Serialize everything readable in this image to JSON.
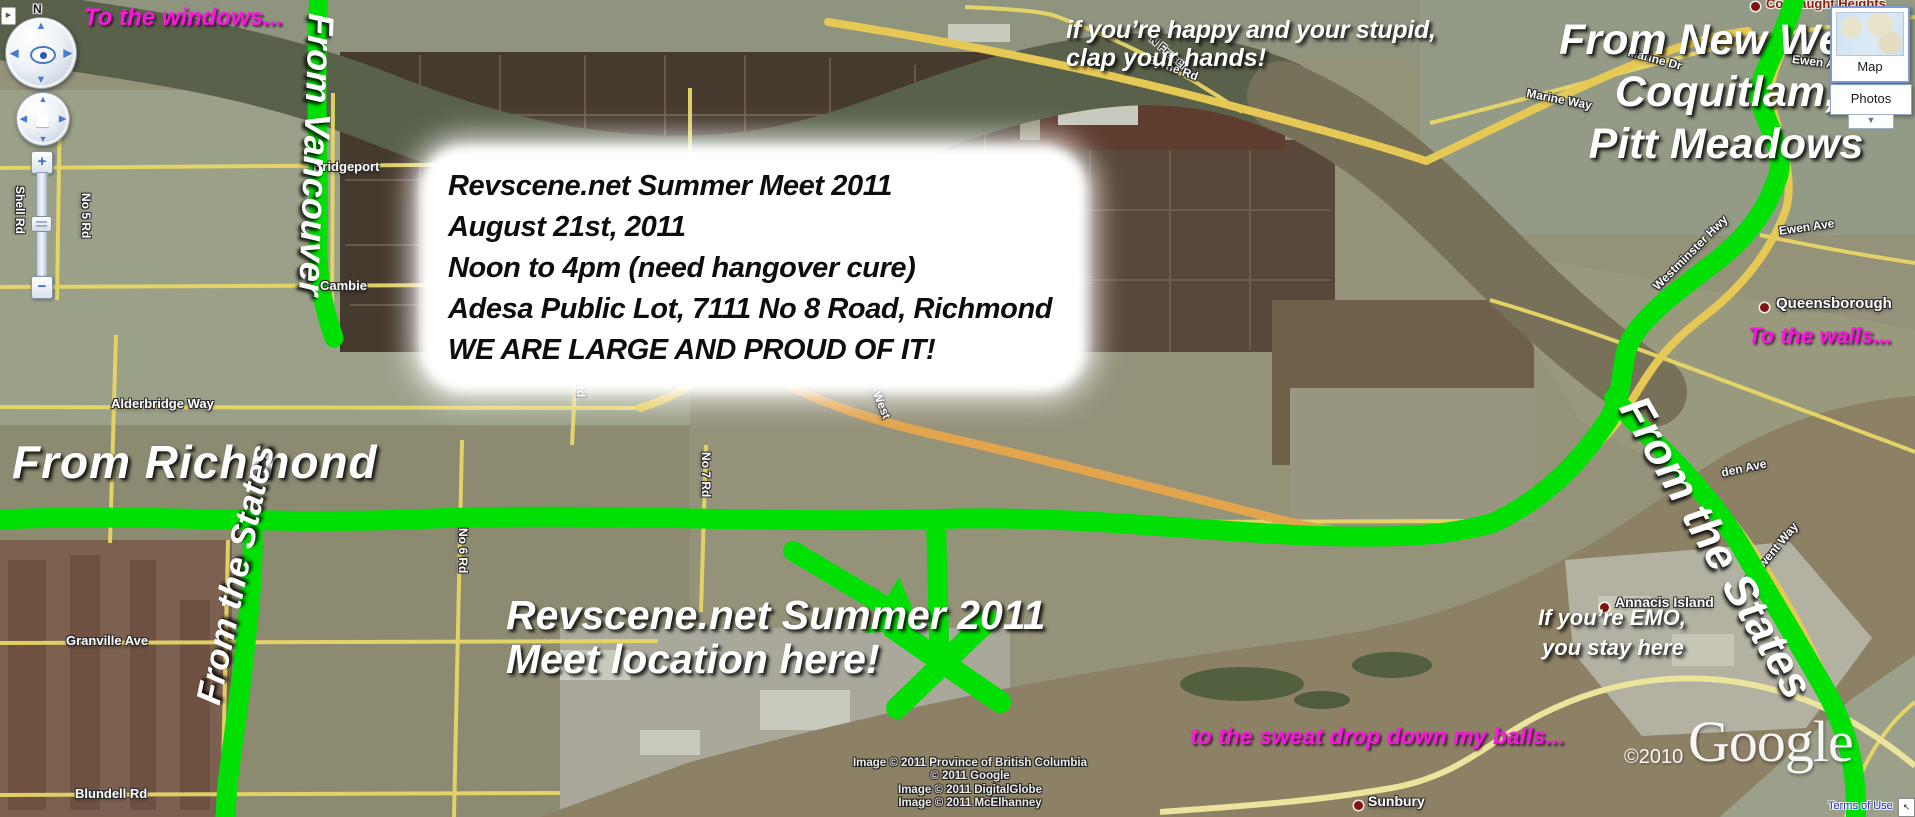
{
  "annotations": {
    "to_windows": "To the windows...",
    "from_vancouver": "From Vancouver",
    "info_lines": [
      "Revscene.net Summer Meet 2011",
      "August 21st, 2011",
      "Noon to 4pm (need hangover cure)",
      "Adesa Public Lot, 7111 No 8 Road, Richmond",
      "WE ARE LARGE AND PROUD OF IT!"
    ],
    "from_richmond": "From Richmond",
    "from_states_left": "From the States",
    "meet_line1": "Revscene.net Summer 2011",
    "meet_line2": "Meet location here!",
    "happy_line1": "if you’re happy and your stupid,",
    "happy_line2": "clap your hands!",
    "new_west_lines": [
      "From New West,",
      "Coquitlam,",
      "Pitt Meadows"
    ],
    "to_walls": "To the walls...",
    "emo_line1": "If you’re EMO,",
    "emo_line2": "you stay here",
    "from_states_right": "From the States",
    "sweat": "to the sweat drop down my balls..."
  },
  "map_labels": {
    "bridgeport": "Bridgeport",
    "cambie": "Cambie",
    "shell_rd": "Shell Rd",
    "no5_rd": "No 5 Rd",
    "alderbridge_way": "Alderbridge Way",
    "granville_ave": "Granville Ave",
    "blundell_rd": "Blundell Rd",
    "no6_rd": "No 6 Rd",
    "no7_rd": "No 7 Rd",
    "no7_rd_2": "No 7 Rd",
    "east_west": "East-West",
    "river_rd": "River Rd",
    "byrne_rd": "Byrne Rd",
    "n_fraser": "N Fraser",
    "marine_way": "Marine Way",
    "marine_dr": "Marine Dr",
    "ewen_ave": "Ewen Ave",
    "ewen_ave_2": "Ewen Ave",
    "westminster_hwy": "Westminster Hwy",
    "queensborough": "Queensborough",
    "connaught_heights": "Connaught Heights",
    "annacis_island": "Annacis Island",
    "sunbury": "Sunbury",
    "derwent_way": "Derwent Way",
    "den_ave": "den Ave"
  },
  "controls": {
    "north": "N",
    "zoom_in": "+",
    "zoom_out": "−",
    "map_button": "Map",
    "photos_button": "Photos"
  },
  "attribution": {
    "logo": "Google",
    "year": "©2010",
    "lines": [
      "Image © 2011 Province of British Columbia",
      "© 2011 Google",
      "Image © 2011 DigitalGlobe",
      "Image © 2011 McElhanney"
    ],
    "terms": "Terms of Use"
  },
  "colors": {
    "route_green": "#00e005",
    "annotation_magenta": "#fb17dd",
    "road_yellow": "#e7d667",
    "highway_orange": "#e2a44c"
  }
}
